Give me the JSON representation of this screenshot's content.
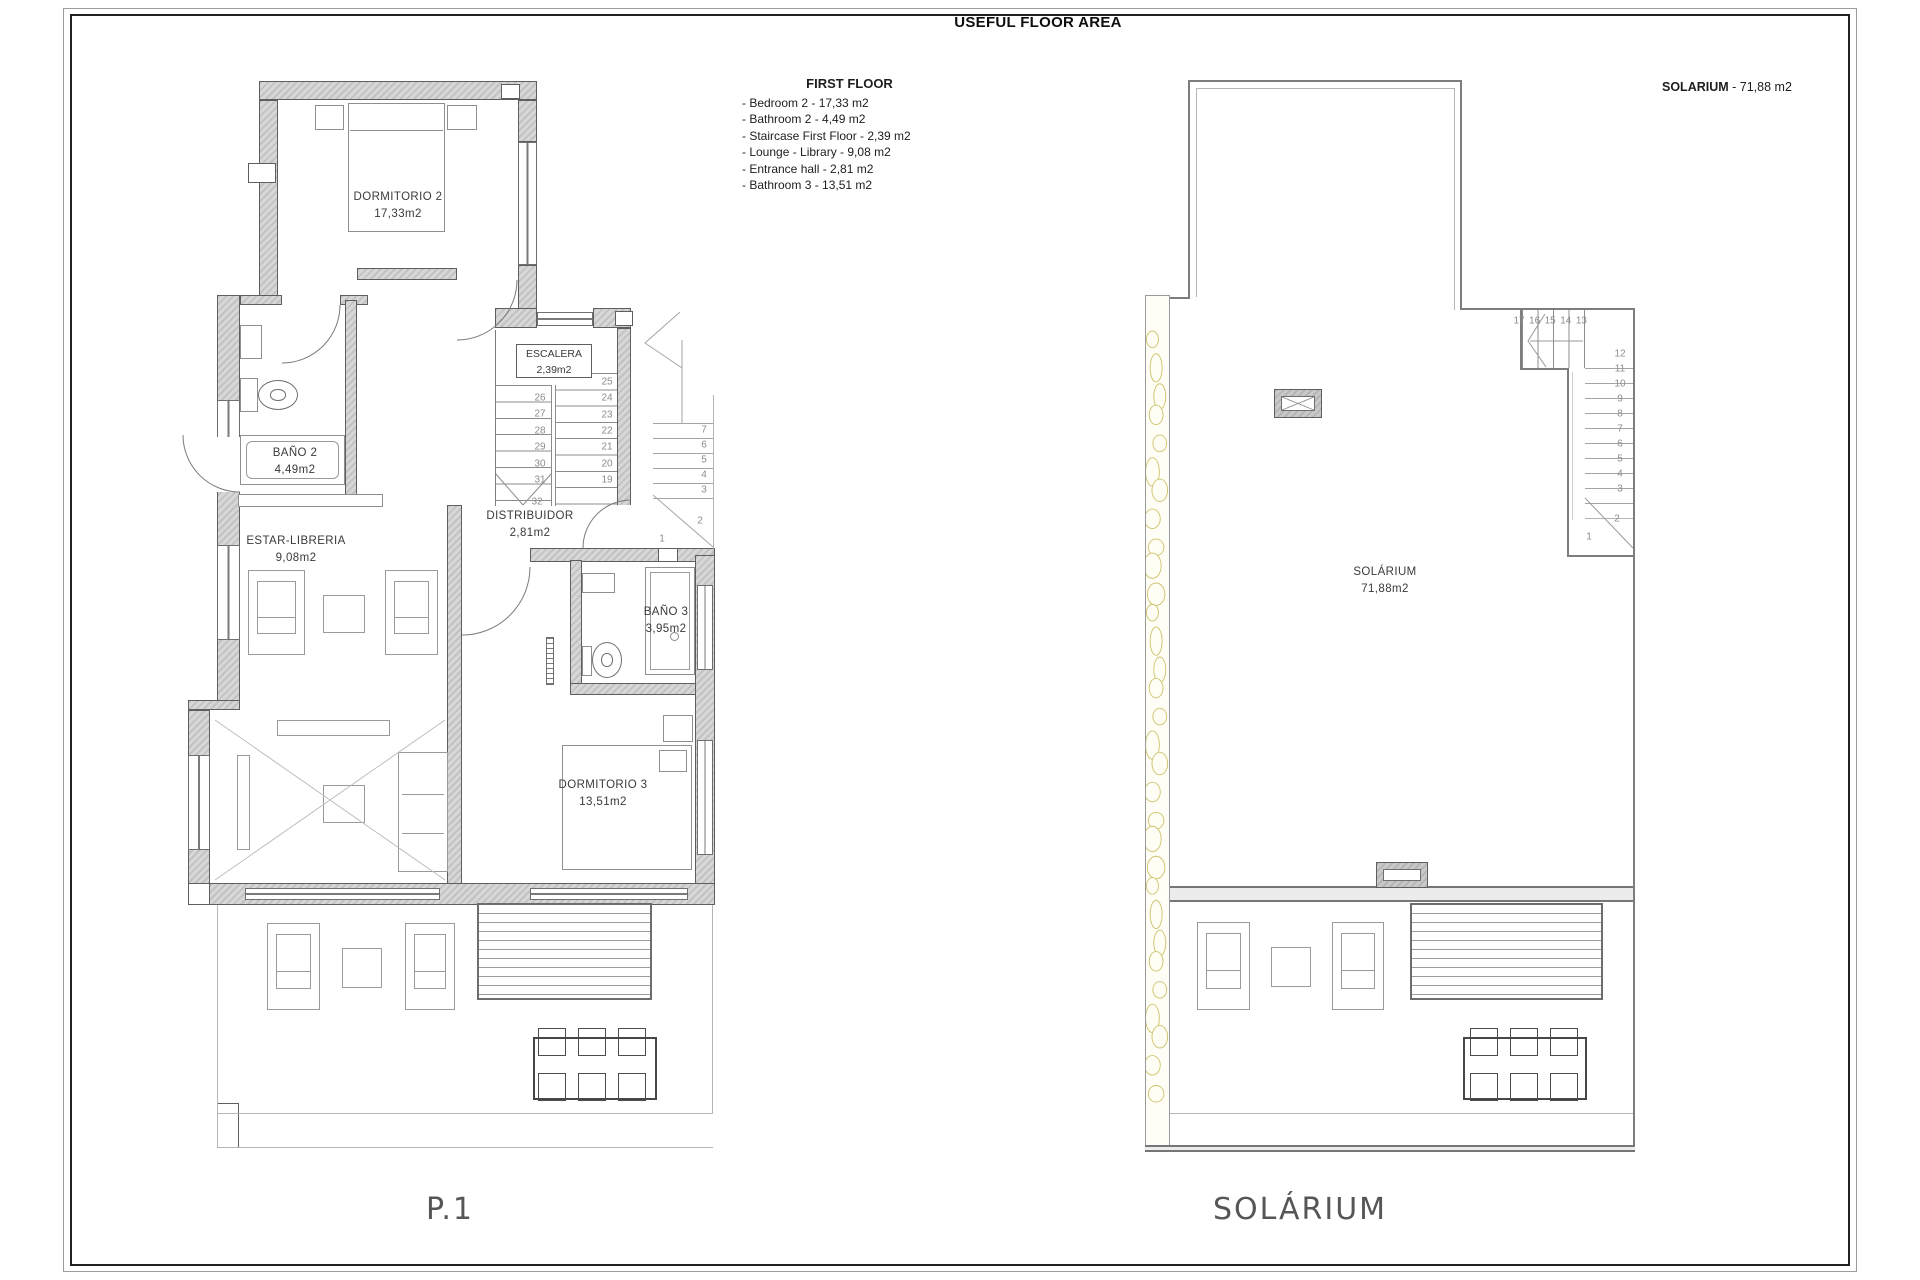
{
  "header": {
    "title": "USEFUL FLOOR AREA"
  },
  "legend": {
    "title": "FIRST FLOOR",
    "items": [
      "- Bedroom 2 - 17,33 m2",
      "- Bathroom 2 - 4,49 m2",
      "- Staircase First Floor - 2,39 m2",
      "- Lounge - Library - 9,08 m2",
      "- Entrance hall - 2,81 m2",
      "- Bathroom 3 - 13,51 m2"
    ]
  },
  "solarium_note": {
    "bold": "SOLARIUM",
    "rest": " - 71,88 m2"
  },
  "left_plan": {
    "label": "P.1",
    "rooms": [
      {
        "name": "DORMITORIO 2",
        "area": "17,33m2"
      },
      {
        "name": "BAÑO 2",
        "area": "4,49m2"
      },
      {
        "name": "ESCALERA",
        "area": "2,39m2"
      },
      {
        "name": "DISTRIBUIDOR",
        "area": "2,81m2"
      },
      {
        "name": "ESTAR-LIBRERIA",
        "area": "9,08m2"
      },
      {
        "name": "BAÑO 3",
        "area": "3,95m2"
      },
      {
        "name": "DORMITORIO 3",
        "area": "13,51m2"
      }
    ],
    "stairs": {
      "flight_up": [
        "26",
        "27",
        "28",
        "29",
        "30",
        "31"
      ],
      "flight_down": [
        "25",
        "24",
        "23",
        "22",
        "21",
        "20",
        "19"
      ],
      "lower_flight": [
        "7",
        "6",
        "5",
        "4",
        "3"
      ],
      "extra": [
        "32",
        "2",
        "1"
      ]
    }
  },
  "right_plan": {
    "label": "SOLÁRIUM",
    "room": {
      "name": "SOLÁRIUM",
      "area": "71,88m2"
    },
    "stairs": {
      "top_flight": [
        "17",
        "16",
        "15",
        "14",
        "13"
      ],
      "main_flight": [
        "12",
        "11",
        "10",
        "9",
        "8",
        "7",
        "6",
        "5",
        "4",
        "3"
      ],
      "extra": [
        "2",
        "1"
      ]
    }
  },
  "colors": {
    "wall": "#c9c9c9",
    "line": "#5e5e5e",
    "light_line": "#9a9a9a",
    "stone": "#cfc36e"
  }
}
